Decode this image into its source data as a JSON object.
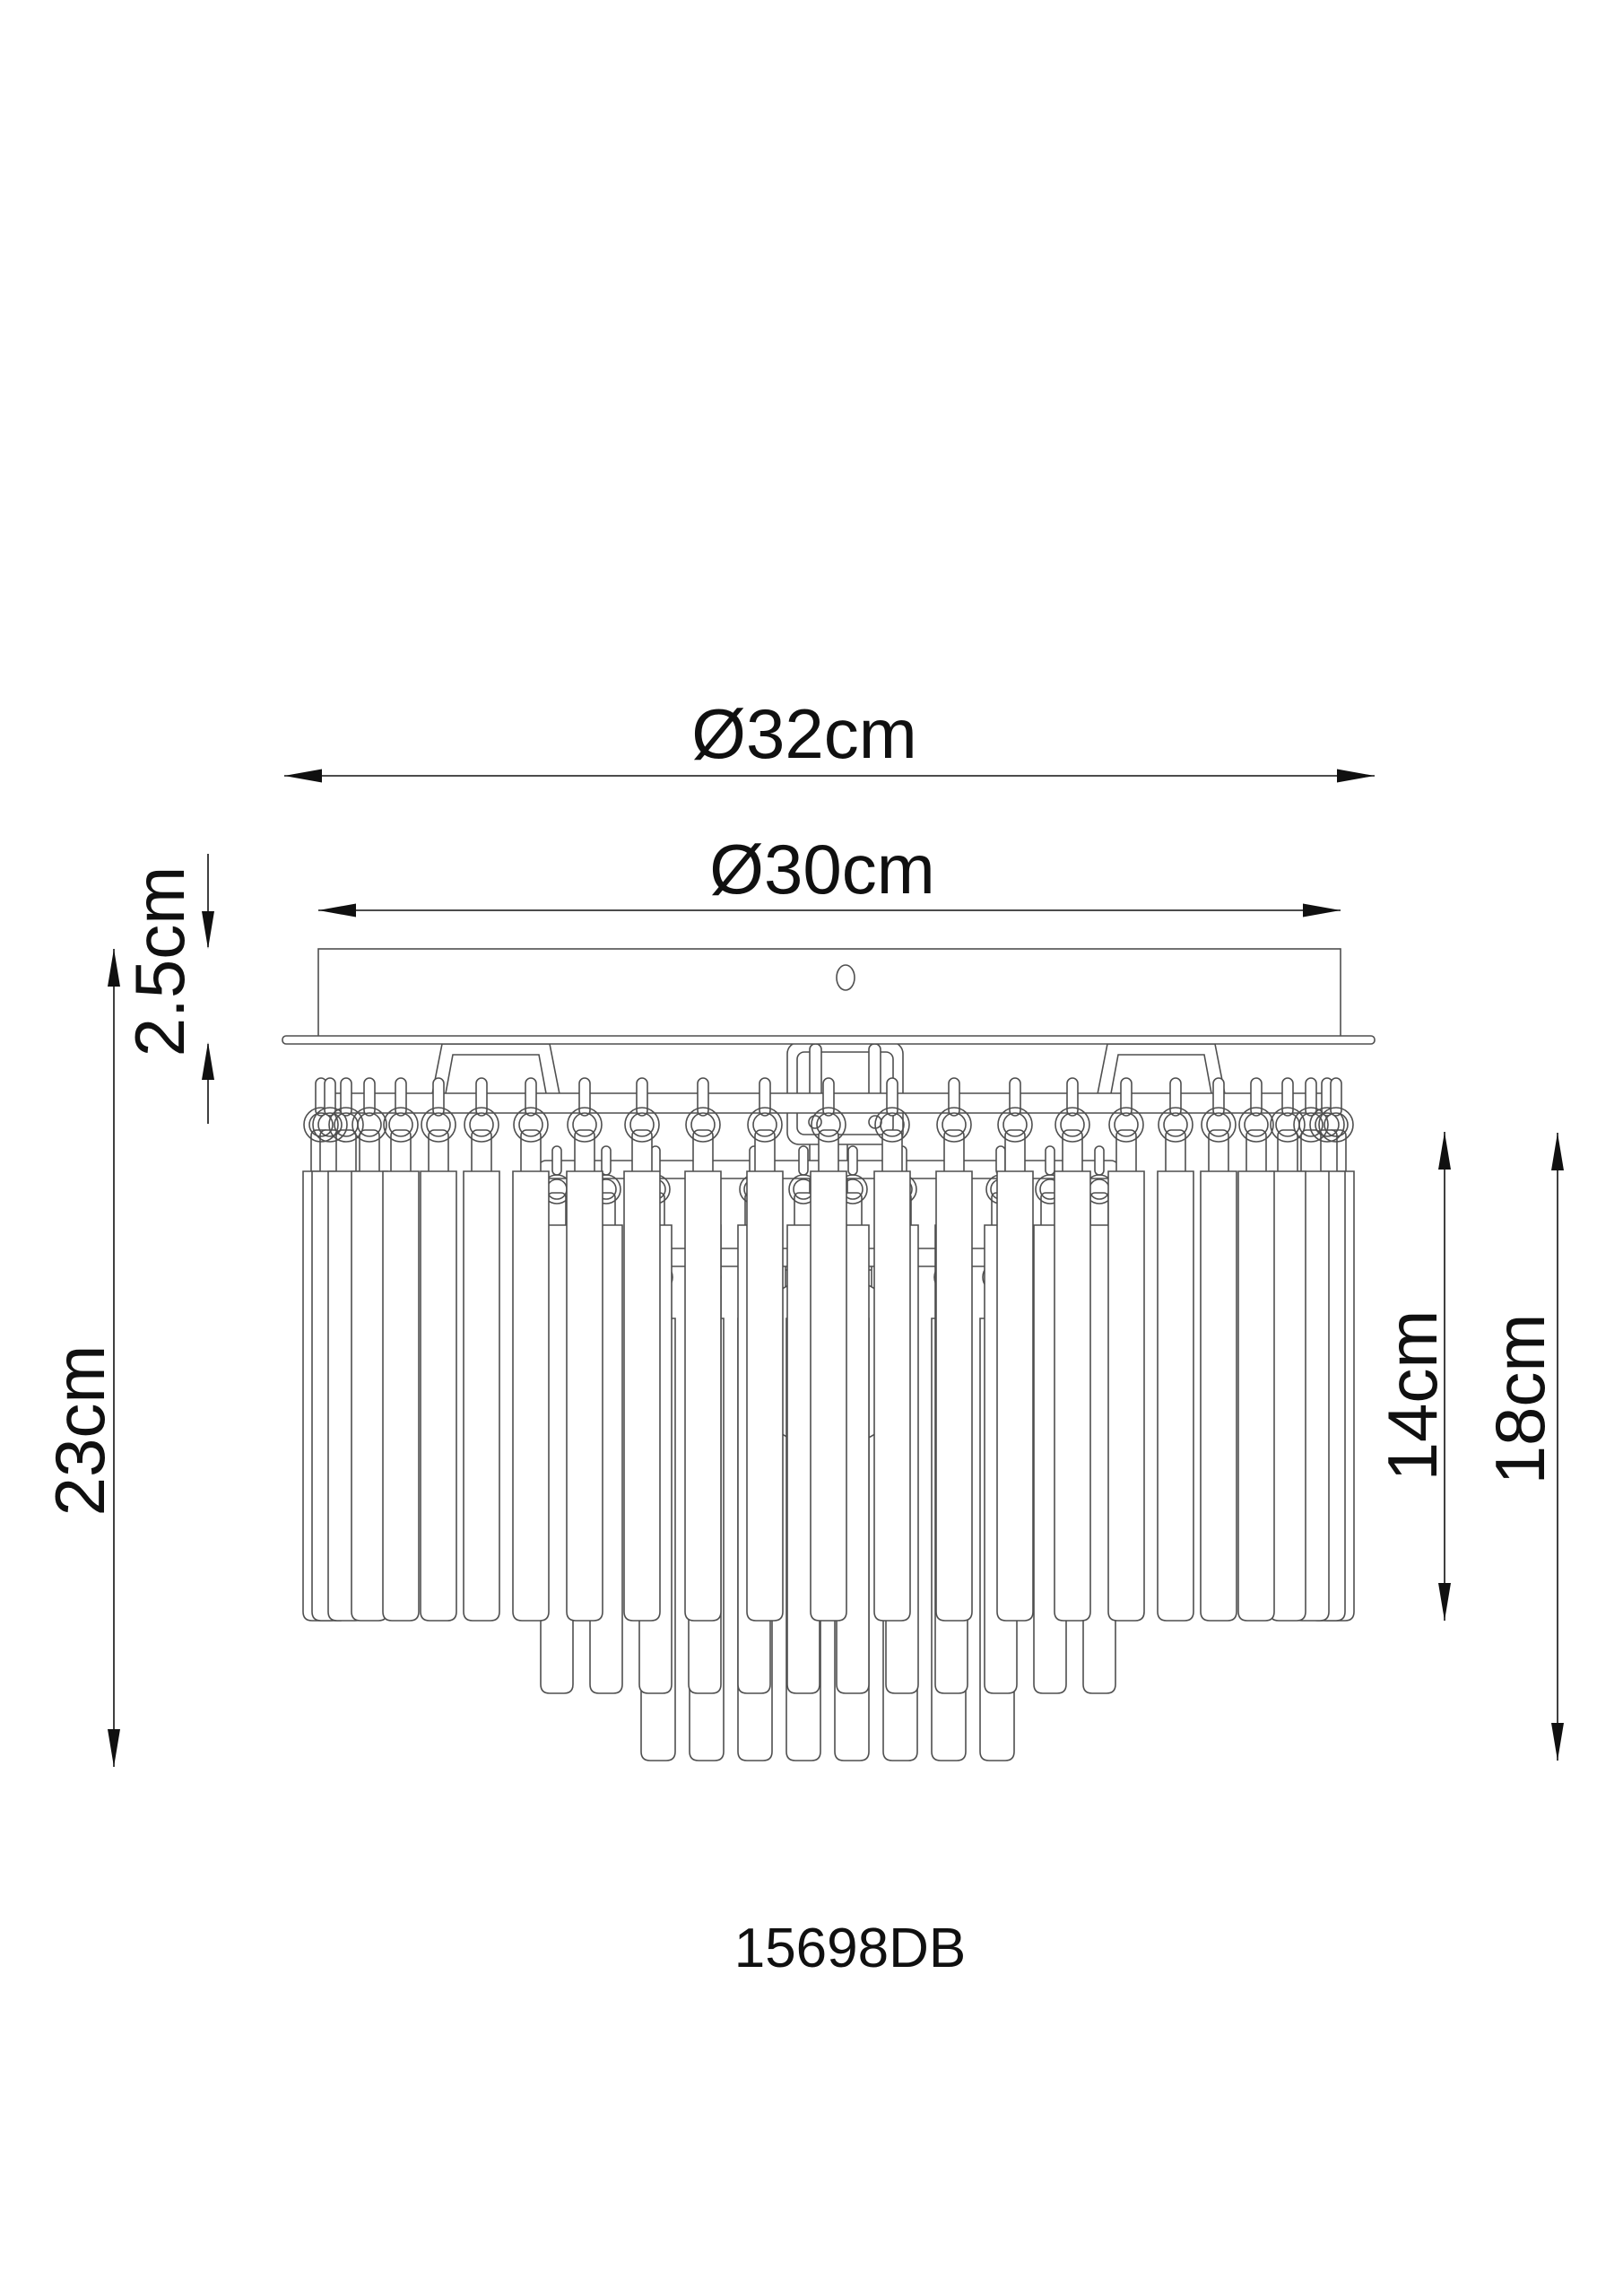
{
  "drawing": {
    "model_number": "15698DB",
    "dimensions": {
      "plate_diameter": "Ø32cm",
      "canopy_diameter": "Ø30cm",
      "canopy_height": "2.5cm",
      "total_height": "23cm",
      "tier_height": "14cm",
      "crystal_body_height": "18cm"
    },
    "colors": {
      "outline": "#4f4f4f",
      "dimension": "#101010",
      "background": "#ffffff"
    }
  }
}
